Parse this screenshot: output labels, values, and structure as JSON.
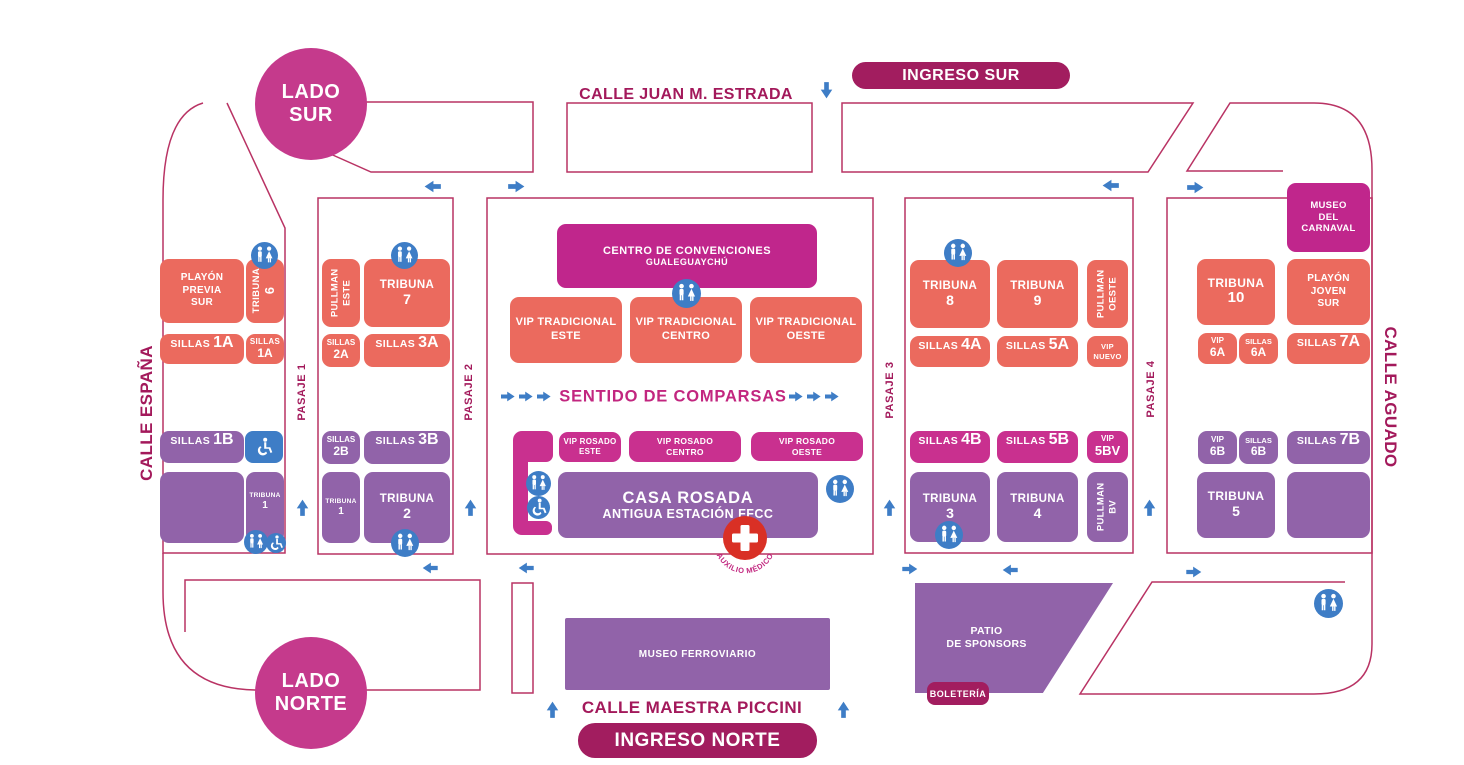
{
  "side_circles": {
    "lado_sur": "LADO\nSUR",
    "lado_norte": "LADO\nNORTE"
  },
  "streets": {
    "juan_estrada": "CALLE JUAN M. ESTRADA",
    "espana": "CALLE ESPAÑA",
    "aguado": "CALLE AGUADO",
    "piccini": "CALLE MAESTRA PICCINI"
  },
  "entrances": {
    "sur": "INGRESO SUR",
    "norte": "INGRESO NORTE",
    "boleteria": "BOLETERÍA"
  },
  "pasajes": {
    "p1": "PASAJE 1",
    "p2": "PASAJE 2",
    "p3": "PASAJE 3",
    "p4": "PASAJE 4"
  },
  "annotations": {
    "sentido": "SENTIDO DE COMPARSAS",
    "auxilio": "AUXILIO MÉDICO"
  },
  "blocks": {
    "playon_previa_sur": {
      "label": "PLAYÓN\nPREVIA\nSUR"
    },
    "tribuna_6": {
      "name": "TRIBUNA",
      "num": "6"
    },
    "sillas_1a": {
      "name": "SILLAS",
      "num": "1A"
    },
    "sillas_1a_s": {
      "name": "SILLAS",
      "num": "1A"
    },
    "sillas_1b": {
      "name": "SILLAS",
      "num": "1B"
    },
    "tribuna_1a": {
      "name": "TRIBUNA",
      "num": "1"
    },
    "pullman_este": {
      "label": "PULLMAN\nESTE"
    },
    "tribuna_7": {
      "name": "TRIBUNA",
      "num": "7"
    },
    "sillas_2a": {
      "name": "SILLAS",
      "num": "2A"
    },
    "sillas_3a": {
      "name": "SILLAS",
      "num": "3A"
    },
    "sillas_2b": {
      "name": "SILLAS",
      "num": "2B"
    },
    "sillas_3b": {
      "name": "SILLAS",
      "num": "3B"
    },
    "tribuna_1b": {
      "name": "TRIBUNA",
      "num": "1"
    },
    "tribuna_2": {
      "name": "TRIBUNA",
      "num": "2"
    },
    "centro_convenciones": {
      "line1": "CENTRO DE CONVENCIONES",
      "line2": "GUALEGUAYCHÚ"
    },
    "vip_trad_este": {
      "label": "VIP TRADICIONAL\nESTE"
    },
    "vip_trad_centro": {
      "label": "VIP TRADICIONAL\nCENTRO"
    },
    "vip_trad_oeste": {
      "label": "VIP TRADICIONAL\nOESTE"
    },
    "vip_rosado_este": {
      "label": "VIP ROSADO\nESTE"
    },
    "vip_rosado_centro": {
      "label": "VIP ROSADO\nCENTRO"
    },
    "vip_rosado_oeste": {
      "label": "VIP ROSADO\nOESTE"
    },
    "casa_rosada": {
      "line1": "CASA ROSADA",
      "line2": "ANTIGUA ESTACIÓN FFCC"
    },
    "tribuna_8": {
      "name": "TRIBUNA",
      "num": "8"
    },
    "tribuna_9": {
      "name": "TRIBUNA",
      "num": "9"
    },
    "pullman_oeste": {
      "label": "PULLMAN\nOESTE"
    },
    "sillas_4a": {
      "name": "SILLAS",
      "num": "4A"
    },
    "sillas_5a": {
      "name": "SILLAS",
      "num": "5A"
    },
    "vip_nuevo": {
      "label": "VIP\nNUEVO"
    },
    "sillas_4b": {
      "name": "SILLAS",
      "num": "4B"
    },
    "sillas_5b": {
      "name": "SILLAS",
      "num": "5B"
    },
    "vip_5bv": {
      "name": "VIP",
      "num": "5BV"
    },
    "tribuna_3": {
      "name": "TRIBUNA",
      "num": "3"
    },
    "tribuna_4": {
      "name": "TRIBUNA",
      "num": "4"
    },
    "pullman_bv": {
      "label": "PULLMAN\nBV"
    },
    "museo_carnaval": {
      "label": "MUSEO\nDEL\nCARNAVAL"
    },
    "tribuna_10": {
      "name": "TRIBUNA",
      "num": "10"
    },
    "playon_joven_sur": {
      "label": "PLAYÓN\nJOVEN\nSUR"
    },
    "vip_6a": {
      "name": "VIP",
      "num": "6A"
    },
    "sillas_6a": {
      "name": "SILLAS",
      "num": "6A"
    },
    "sillas_7a": {
      "name": "SILLAS",
      "num": "7A"
    },
    "vip_6b": {
      "name": "VIP",
      "num": "6B"
    },
    "sillas_6b": {
      "name": "SILLAS",
      "num": "6B"
    },
    "sillas_7b": {
      "name": "SILLAS",
      "num": "7B"
    },
    "tribuna_5": {
      "name": "TRIBUNA",
      "num": "5"
    },
    "museo_ferroviario": {
      "label": "MUSEO FERROVIARIO"
    },
    "patio_sponsors": {
      "label": "PATIO\nDE SPONSORS"
    }
  },
  "icons": {
    "restroom": "man-woman-restroom",
    "wheelchair": "wheelchair-accessible",
    "medical": "medical-red-cross",
    "arrow": "direction-arrow"
  },
  "colors": {
    "salmon": "#EB6A5E",
    "purple": "#9163A9",
    "magenta": "#C9308F",
    "deep_magenta": "#C0268C",
    "pill_dark": "#A21D5F",
    "street_text": "#A3195B",
    "outline": "#B93364",
    "blue": "#3E7DC6",
    "red_cross": "#D93025"
  }
}
